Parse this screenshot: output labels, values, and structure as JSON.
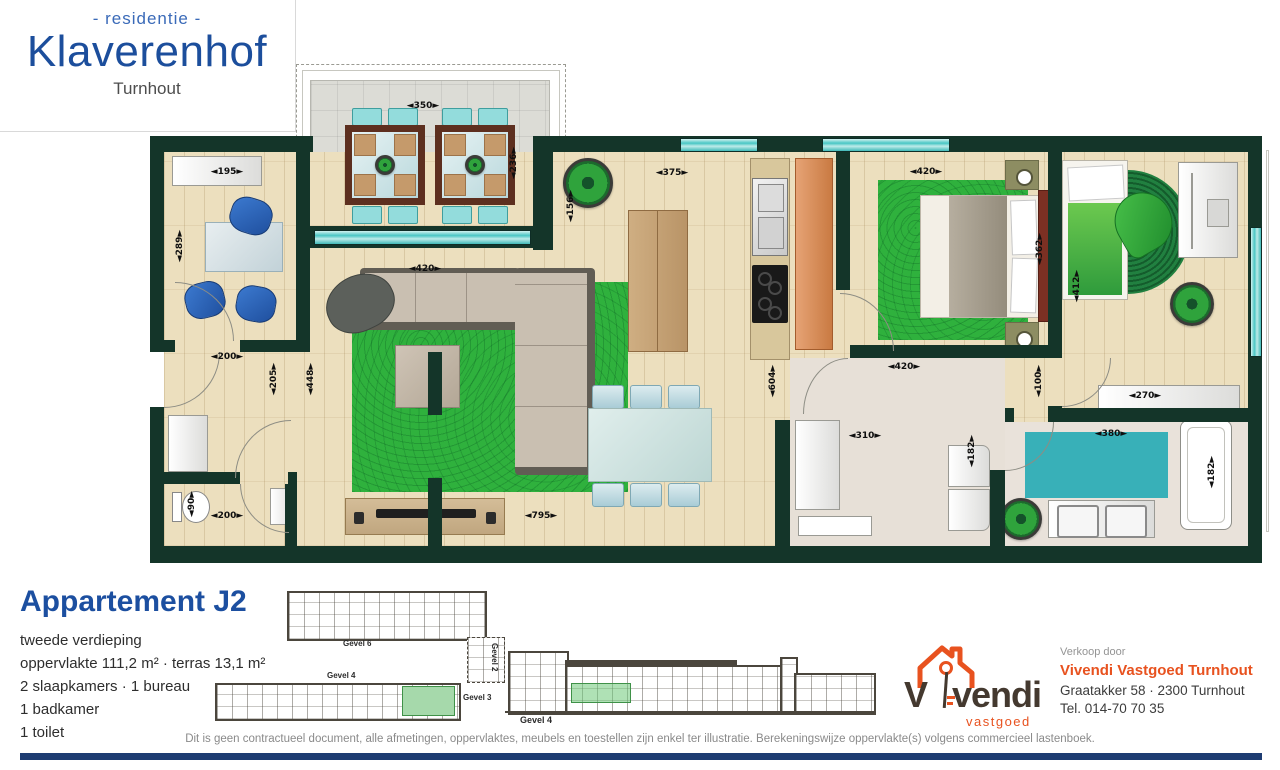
{
  "brand": {
    "residentie": "- residentie -",
    "name": "Klaverenhof",
    "city": "Turnhout"
  },
  "apartment": {
    "title": "Appartement J2",
    "floor": "tweede verdieping",
    "area": "oppervlakte 111,2 m² · terras 13,1 m²",
    "rooms": "2 slaapkamers · 1 bureau",
    "bathroom": "1 badkamer",
    "toilet": "1 toilet"
  },
  "plan": {
    "dims": [
      {
        "t": "◄350►"
      },
      {
        "t": "◄236►"
      },
      {
        "t": "◄195►"
      },
      {
        "t": "◄289►"
      },
      {
        "t": "◄375►"
      },
      {
        "t": "◄156►"
      },
      {
        "t": "◄420►"
      },
      {
        "t": "◄604►"
      },
      {
        "t": "◄420►"
      },
      {
        "t": "◄362►"
      },
      {
        "t": "◄412►"
      },
      {
        "t": "◄200►"
      },
      {
        "t": "◄205►"
      },
      {
        "t": "◄448►"
      },
      {
        "t": "◄90►"
      },
      {
        "t": "◄200►"
      },
      {
        "t": "◄795►"
      },
      {
        "t": "◄420►"
      },
      {
        "t": "◄310►"
      },
      {
        "t": "◄100►"
      },
      {
        "t": "◄270►"
      },
      {
        "t": "◄380►"
      },
      {
        "t": "◄182►"
      },
      {
        "t": "◄182►"
      }
    ]
  },
  "siteplan": {
    "gevel6": "Gevel 6",
    "gevel2": "Gevel 2",
    "gevel4": "Gevel 4",
    "gevel3": "Gevel 3"
  },
  "elevation": {
    "label": "Gevel 4"
  },
  "vendor": {
    "verkoop": "Verkoop door",
    "name": "Vivendi Vastgoed Turnhout",
    "address": "Graatakker 58 · 2300 Turnhout",
    "tel": "Tel. 014-70 70 35",
    "logo_v": "V",
    "logo_rest": "vendi",
    "logo_sub": "vastgoed"
  },
  "disclaimer": "Dit is geen contractueel document, alle afmetingen, oppervlaktes, meubels en toestellen zijn enkel ter illustratie. Berekeningswijze oppervlakte(s) volgens commercieel lastenboek.",
  "colors": {
    "wall": "#143529",
    "brand_blue": "#1c4e9c",
    "orange": "#e8521f",
    "window_teal": "#49c6c4",
    "rug_green": "#2fb13d",
    "navy_bar": "#1e3c72"
  }
}
